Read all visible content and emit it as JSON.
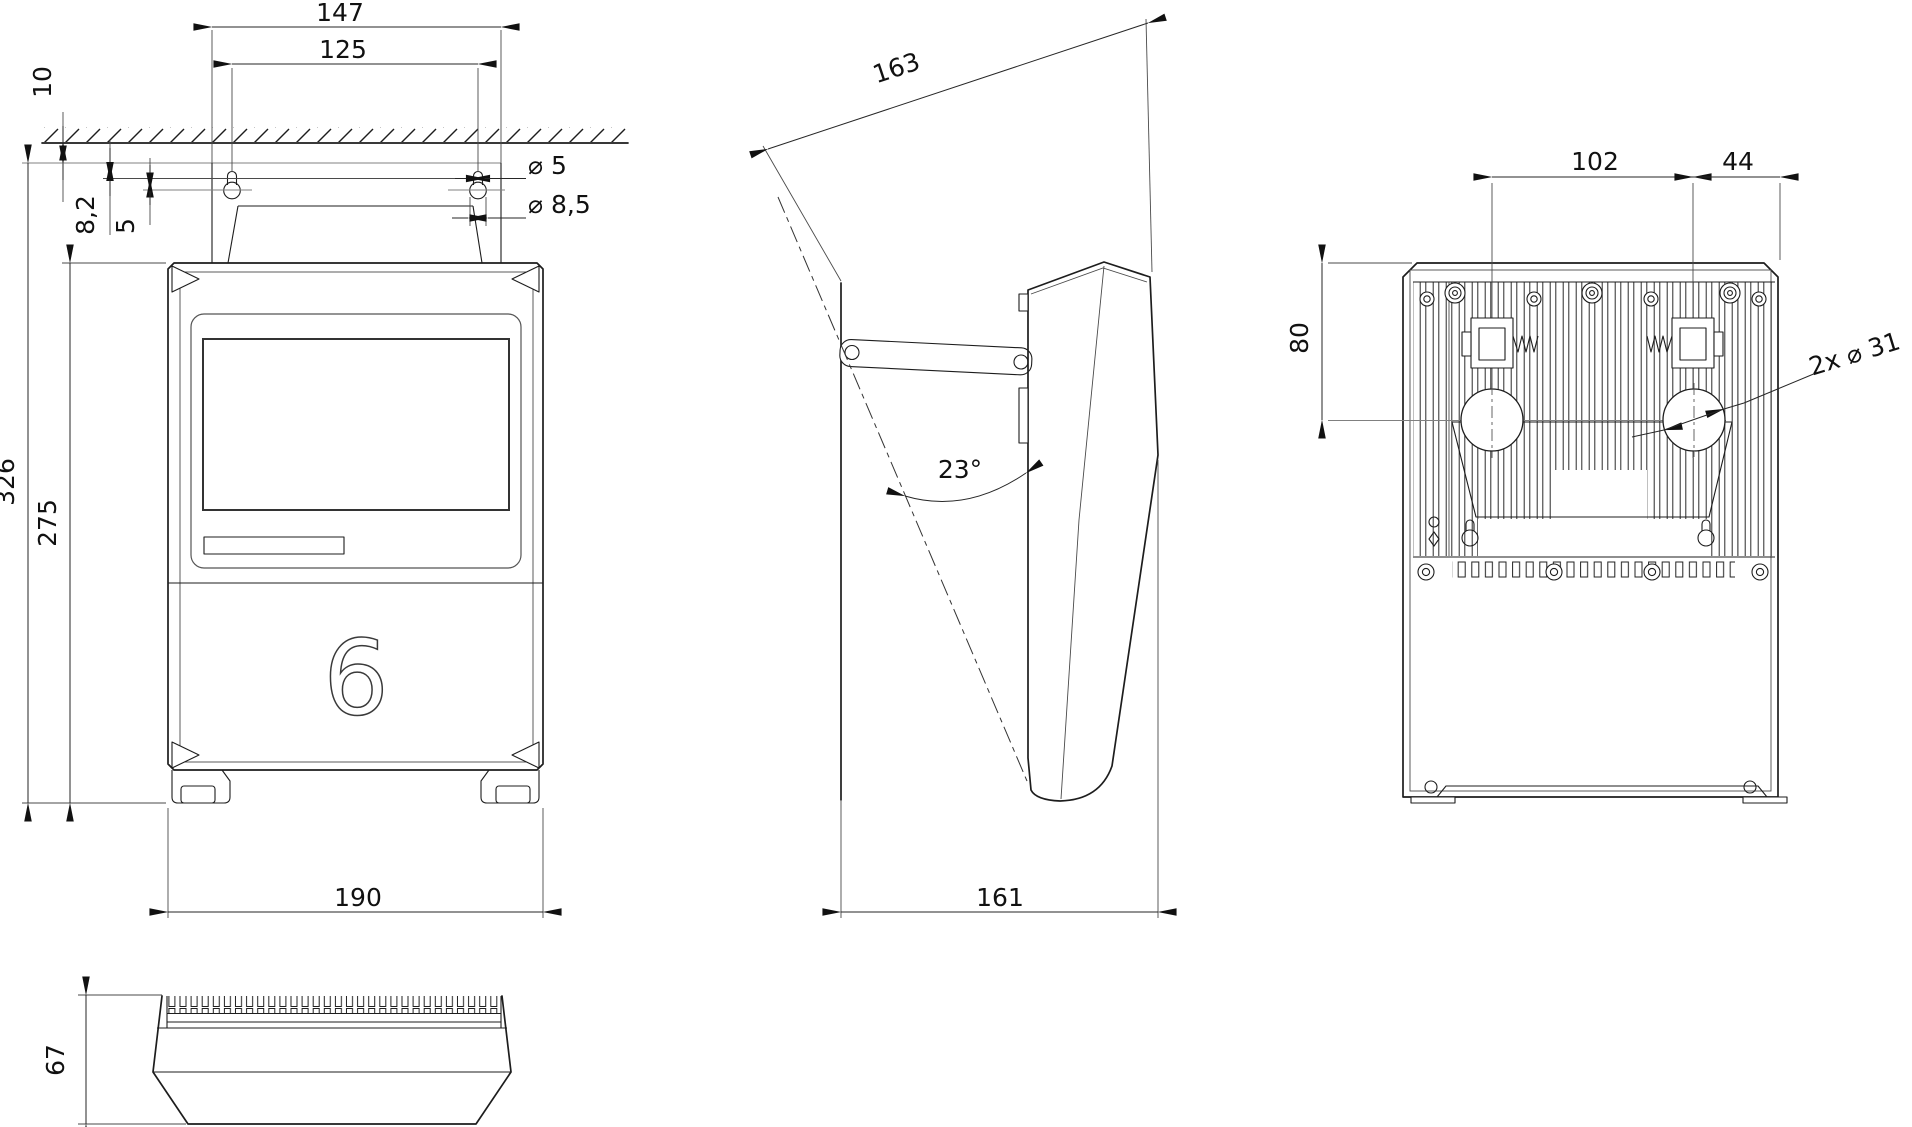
{
  "drawing": {
    "title": "wall-mounted-controller-dimension-drawing",
    "colors": {
      "line": "#1d1d1d",
      "reference": "#808080",
      "background": "#ffffff"
    },
    "logo": "6",
    "dims": {
      "front_mount_width": "147",
      "front_hole_spacing": "125",
      "front_wall_gap": "10",
      "front_slot_drop": "8,2",
      "front_hole_drop": "5",
      "front_slot_dia": "⌀ 5",
      "front_hole_dia": "⌀ 8,5",
      "front_total_height": "326",
      "front_height": "275",
      "front_width": "190",
      "side_slant_length": "163",
      "side_tilt_angle": "23°",
      "side_depth": "161",
      "back_boss_spacing": "102",
      "back_right_offset": "44",
      "back_top_to_hole": "80",
      "back_grommets": "2x ⌀ 31",
      "top_height": "67"
    }
  }
}
